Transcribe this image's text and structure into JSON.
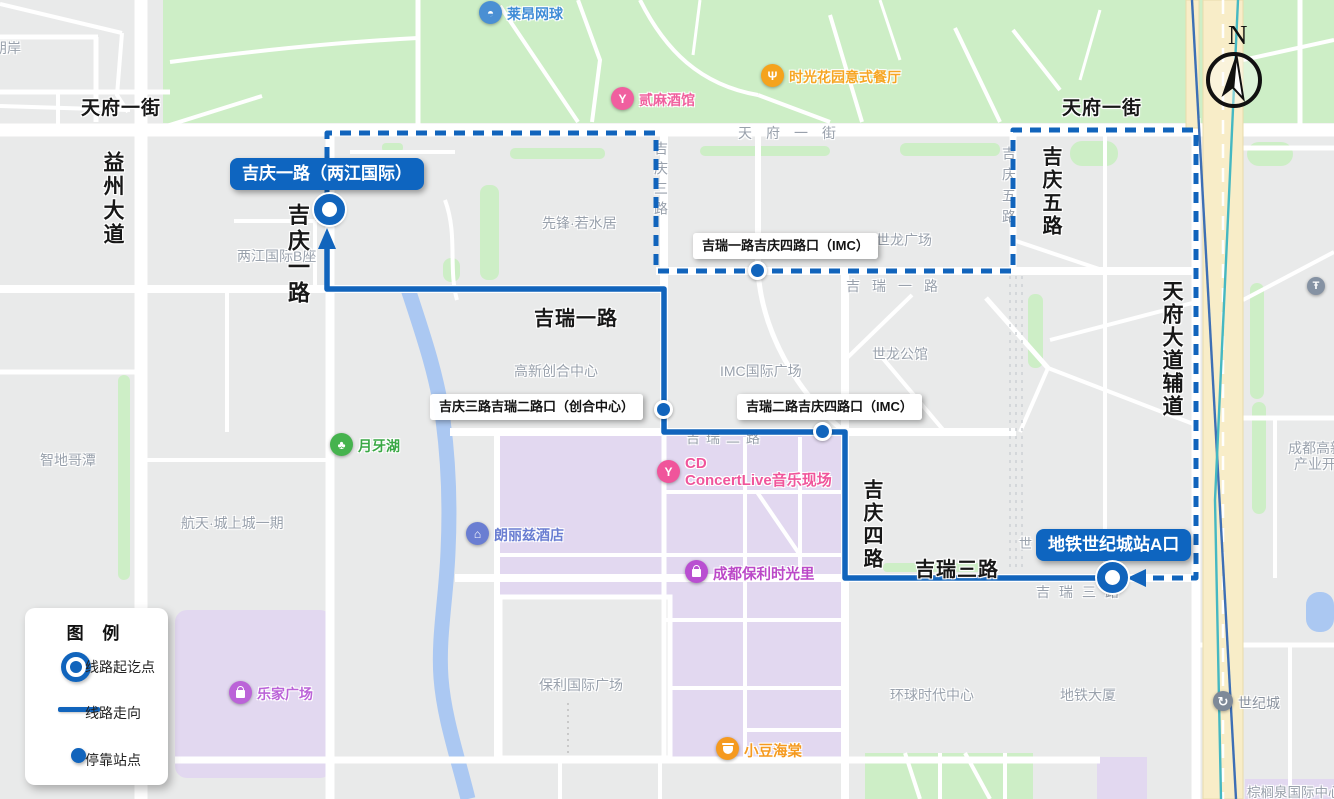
{
  "legend": {
    "title": "图 例",
    "items": [
      {
        "label": "线路起讫点"
      },
      {
        "label": "线路走向"
      },
      {
        "label": "停靠站点"
      }
    ]
  },
  "compass": {
    "north": "N"
  },
  "stations": [
    {
      "name": "吉庆一路（两江国际）",
      "type": "terminal"
    },
    {
      "name": "吉瑞一路吉庆四路口（IMC）",
      "type": "stop"
    },
    {
      "name": "吉庆三路吉瑞二路口（创合中心）",
      "type": "stop"
    },
    {
      "name": "吉瑞二路吉庆四路口（IMC）",
      "type": "stop"
    },
    {
      "name": "地铁世纪城站A口",
      "type": "terminal"
    }
  ],
  "road_labels": {
    "bold": [
      {
        "text": "天府一街"
      },
      {
        "text": "天府一街"
      },
      {
        "text": "益州大道"
      },
      {
        "text": "吉庆一路"
      },
      {
        "text": "吉瑞一路"
      },
      {
        "text": "吉庆五路"
      },
      {
        "text": "吉庆四路"
      },
      {
        "text": "吉瑞三路"
      },
      {
        "text": "天府大道辅道"
      }
    ],
    "gray": [
      {
        "text": "天府一街"
      },
      {
        "text": "吉庆三路"
      },
      {
        "text": "吉庆五路"
      },
      {
        "text": "吉瑞一路"
      },
      {
        "text": "吉瑞二路"
      },
      {
        "text": "吉瑞三路"
      }
    ]
  },
  "place_labels": [
    {
      "text": "朗岸"
    },
    {
      "text": "两江国际B座"
    },
    {
      "text": "先锋·若水居"
    },
    {
      "text": "世龙广场"
    },
    {
      "text": "IMC国际广场"
    },
    {
      "text": "世龙公馆"
    },
    {
      "text": "高新创合中心"
    },
    {
      "text": "智地哥潭"
    },
    {
      "text": "航天·城上城一期"
    },
    {
      "text": "保利国际广场"
    },
    {
      "text": "环球时代中心"
    },
    {
      "text": "地铁大厦"
    },
    {
      "line1": "成都高新",
      "line2": "产业开"
    },
    {
      "text": "棕榈泉国际中心"
    },
    {
      "text": "世"
    }
  ],
  "pois": [
    {
      "label": "莱昂网球",
      "glyph": "◓"
    },
    {
      "label": "贰麻酒馆",
      "glyph": "Y"
    },
    {
      "label": "时光花园意式餐厅",
      "glyph": "Ψ"
    },
    {
      "label": "月牙湖",
      "glyph": "♣"
    },
    {
      "label": "朗丽兹酒店",
      "glyph": "⌂"
    },
    {
      "line1": "CD",
      "line2": "ConcertLive音乐现场",
      "glyph": "Y"
    },
    {
      "label": "成都保利时光里"
    },
    {
      "label": "小豆海棠"
    },
    {
      "label": "乐家广场"
    },
    {
      "label": "世纪城",
      "glyph": "↻"
    },
    {
      "label": "",
      "glyph": "Ŧ"
    }
  ],
  "colors": {
    "route_blue": "#1164bc",
    "bubble_blue": "#0e65c0",
    "park_green": "#cdeec6",
    "block_purple": "#e2d8f0",
    "water_blue": "#abc8f2",
    "road_yellow": "#f8edc8"
  }
}
